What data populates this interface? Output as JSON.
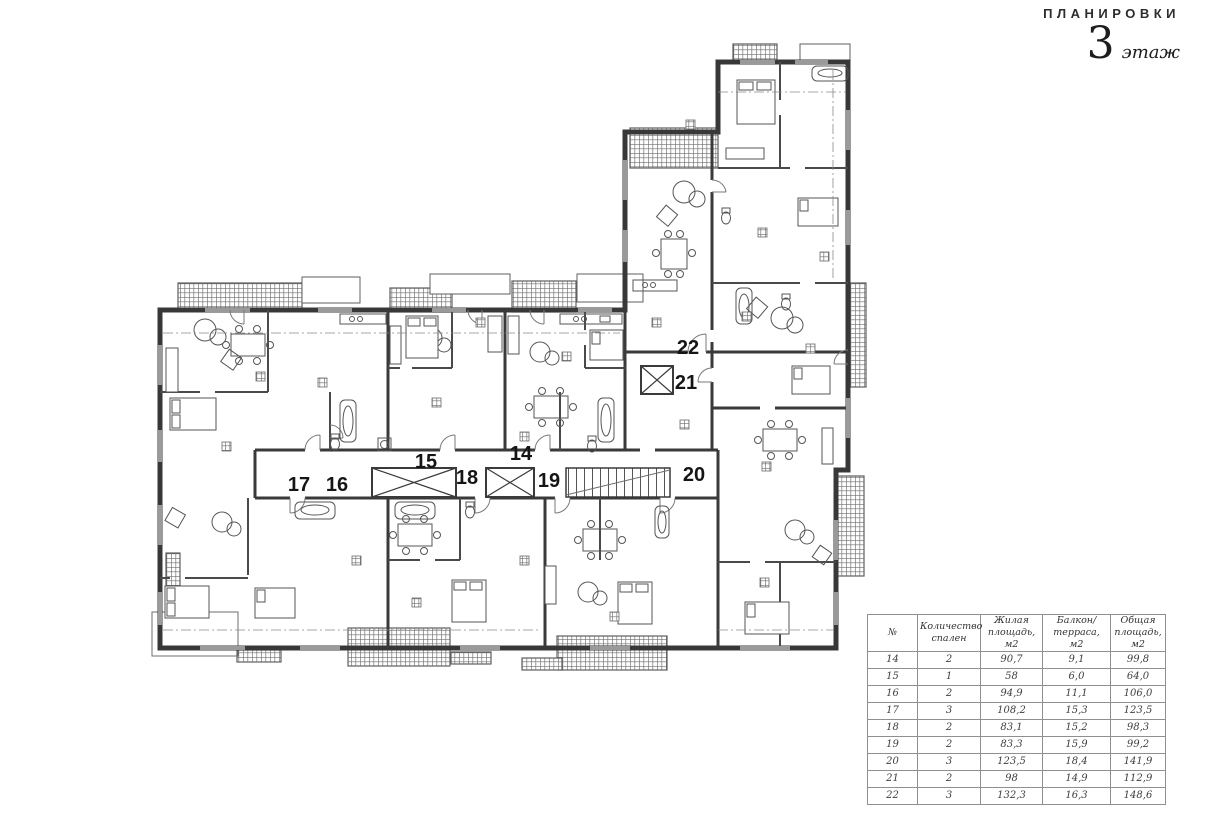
{
  "header": {
    "title": "ПЛАНИРОВКИ",
    "floor_number": "3",
    "floor_word": "этаж"
  },
  "plan": {
    "units": [
      {
        "id": "14",
        "label": "14"
      },
      {
        "id": "15",
        "label": "15"
      },
      {
        "id": "16",
        "label": "16"
      },
      {
        "id": "17",
        "label": "17"
      },
      {
        "id": "18",
        "label": "18"
      },
      {
        "id": "19",
        "label": "19"
      },
      {
        "id": "20",
        "label": "20"
      },
      {
        "id": "21",
        "label": "21"
      },
      {
        "id": "22",
        "label": "22"
      }
    ]
  },
  "table": {
    "headers": [
      "№",
      "Количество спален",
      "Жилая площадь, м2",
      "Балкон/ терраса, м2",
      "Общая площадь, м2"
    ],
    "rows": [
      {
        "num": "14",
        "bedrooms": "2",
        "living_area": "90,7",
        "balcony_area": "9,1",
        "total_area": "99,8"
      },
      {
        "num": "15",
        "bedrooms": "1",
        "living_area": "58",
        "balcony_area": "6,0",
        "total_area": "64,0"
      },
      {
        "num": "16",
        "bedrooms": "2",
        "living_area": "94,9",
        "balcony_area": "11,1",
        "total_area": "106,0"
      },
      {
        "num": "17",
        "bedrooms": "3",
        "living_area": "108,2",
        "balcony_area": "15,3",
        "total_area": "123,5"
      },
      {
        "num": "18",
        "bedrooms": "2",
        "living_area": "83,1",
        "balcony_area": "15,2",
        "total_area": "98,3"
      },
      {
        "num": "19",
        "bedrooms": "2",
        "living_area": "83,3",
        "balcony_area": "15,9",
        "total_area": "99,2"
      },
      {
        "num": "20",
        "bedrooms": "3",
        "living_area": "123,5",
        "balcony_area": "18,4",
        "total_area": "141,9"
      },
      {
        "num": "21",
        "bedrooms": "2",
        "living_area": "98",
        "balcony_area": "14,9",
        "total_area": "112,9"
      },
      {
        "num": "22",
        "bedrooms": "3",
        "living_area": "132,3",
        "balcony_area": "16,3",
        "total_area": "148,6"
      }
    ]
  },
  "colors": {
    "wall": "#3a3a3a",
    "text": "#2d2d2d",
    "table_border": "#8f8f8f"
  }
}
